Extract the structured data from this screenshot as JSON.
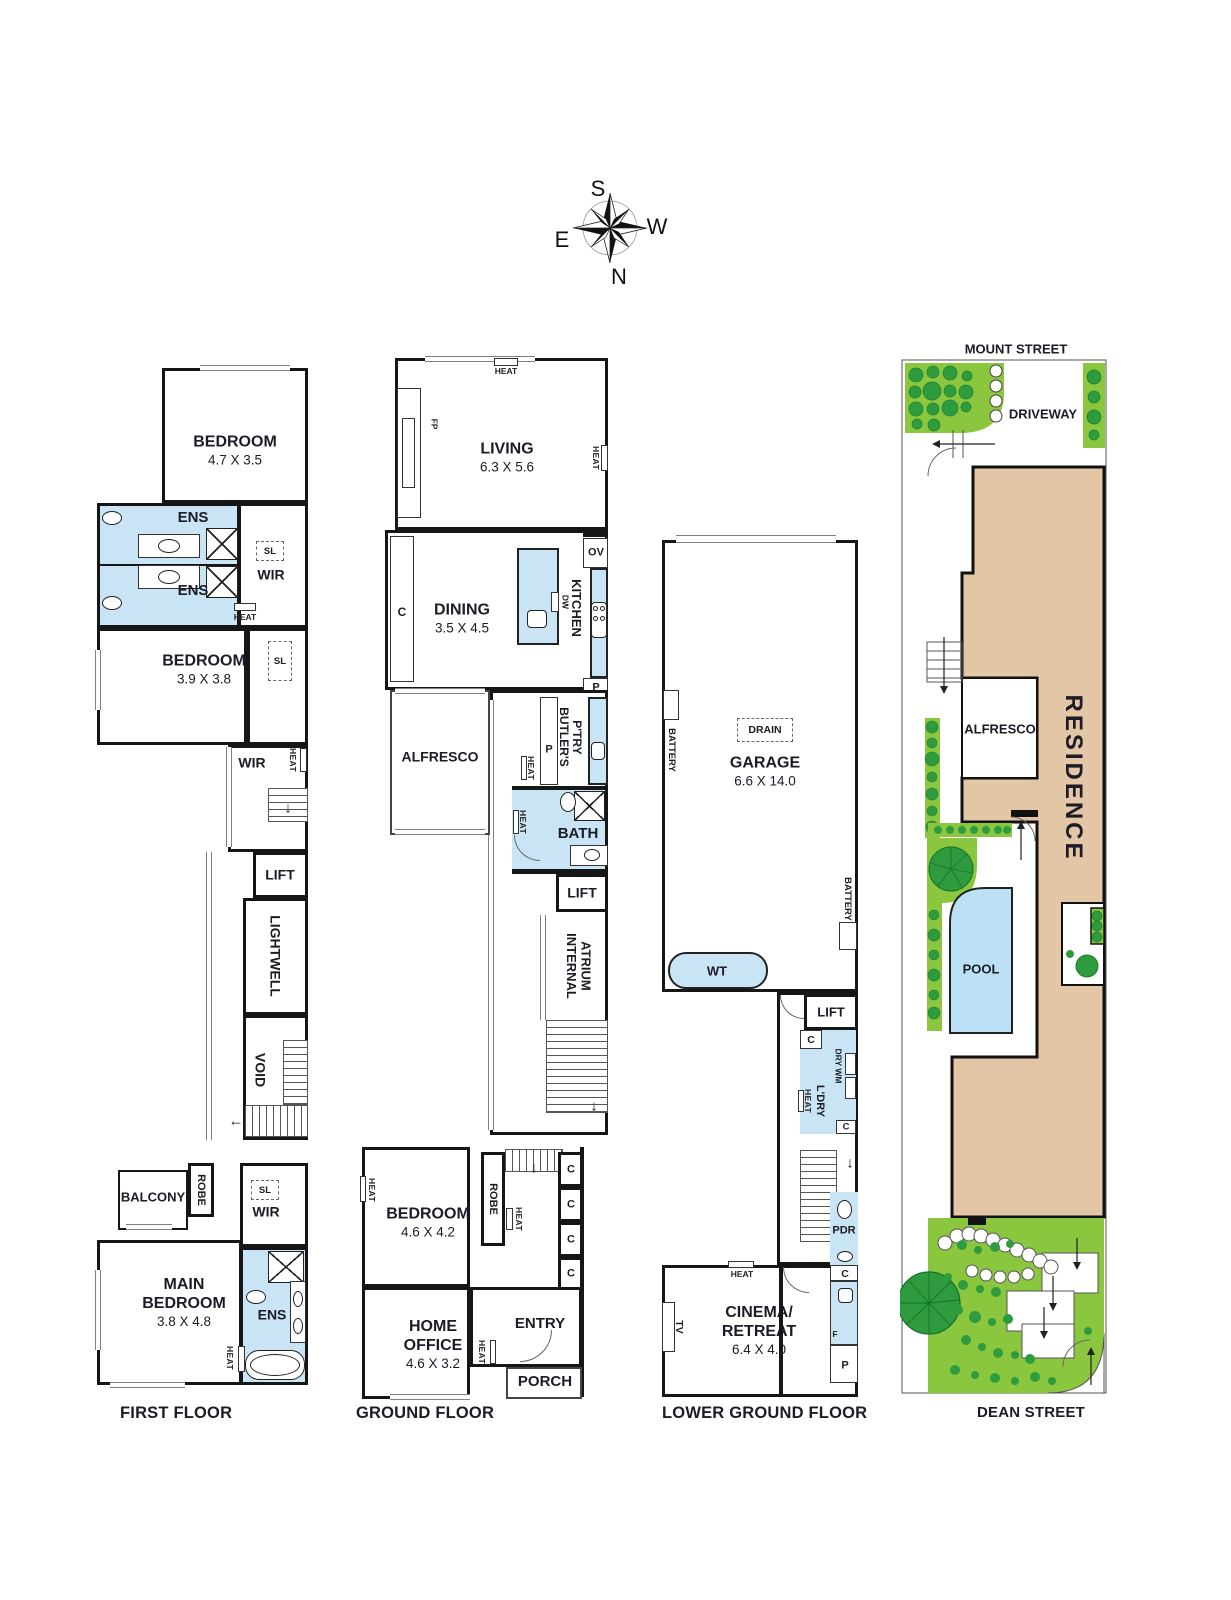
{
  "compass": {
    "top": "S",
    "right": "W",
    "left": "E",
    "bottom": "N"
  },
  "icons": {
    "down_arrow": "↓",
    "up_arrow": "↑",
    "left_arrow": "←"
  },
  "first_floor": {
    "caption": "FIRST FLOOR",
    "bedroom1": {
      "name": "BEDROOM",
      "dim": "4.7 X 3.5"
    },
    "ens_top": "ENS",
    "ens_mid": "ENS",
    "ens_main": "ENS",
    "sl_top": "SL",
    "sl_mid": "SL",
    "sl_lower": "SL",
    "wir_top": "WIR",
    "wir_mid": "WIR",
    "wir_lower": "WIR",
    "heat_ens": "HEAT",
    "heat_hall": "HEAT",
    "heat_main": "HEAT",
    "bedroom2": {
      "name": "BEDROOM",
      "dim": "3.9 X 3.8"
    },
    "lift": "LIFT",
    "lightwell": "LIGHTWELL",
    "void": "VOID",
    "balcony": "BALCONY",
    "robe": "ROBE",
    "main_bedroom": {
      "line1": "MAIN",
      "line2": "BEDROOM",
      "dim": "3.8 X 4.8"
    }
  },
  "ground_floor": {
    "caption": "GROUND FLOOR",
    "heat_living_top": "HEAT",
    "heat_living_right": "HEAT",
    "fp": "FP",
    "living": {
      "name": "LIVING",
      "dim": "6.3 X 5.6"
    },
    "cupboard": "C",
    "dining": {
      "name": "DINING",
      "dim": "3.5 X 4.5"
    },
    "dw": "DW",
    "kitchen": "KITCHEN",
    "oven": "OV",
    "pantry_kitchen": "P",
    "butlers": {
      "line1": "BUTLER'S",
      "line2": "P'TRY"
    },
    "pantry_butlers": "P",
    "heat_butlers": "HEAT",
    "alfresco": "ALFRESCO",
    "bath": "BATH",
    "heat_bath": "HEAT",
    "lift": "LIFT",
    "atrium": {
      "line1": "INTERNAL",
      "line2": "ATRIUM"
    },
    "heat_bedroom": "HEAT",
    "bedroom": {
      "name": "BEDROOM",
      "dim": "4.6 X 4.2"
    },
    "robe": "ROBE",
    "heat_robe": "HEAT",
    "c1": "C",
    "c2": "C",
    "c3": "C",
    "c4": "C",
    "home_office": {
      "line1": "HOME",
      "line2": "OFFICE",
      "dim": "4.6 X 3.2"
    },
    "entry": "ENTRY",
    "heat_entry": "HEAT",
    "porch": "PORCH"
  },
  "lower_ground": {
    "caption": "LOWER GROUND FLOOR",
    "battery_left": "BATTERY",
    "battery_right": "BATTERY",
    "drain": "DRAIN",
    "garage": {
      "name": "GARAGE",
      "dim": "6.6 X 14.0"
    },
    "water_tank": "WT",
    "lift": "LIFT",
    "c_top": "C",
    "dry_wm": "DRY WM",
    "laundry": "L'DRY",
    "heat_laundry": "HEAT",
    "c_mid": "C",
    "powder": "PDR",
    "c_right": "C",
    "heat_cinema": "HEAT",
    "tv": "TV",
    "cinema": {
      "line1": "CINEMA/",
      "line2": "RETREAT",
      "dim": "6.4 X 4.0"
    },
    "fridge": "F",
    "pantry": "P"
  },
  "site_plan": {
    "street_top": "MOUNT STREET",
    "driveway": "DRIVEWAY",
    "residence": "RESIDENCE",
    "alfresco": "ALFRESCO",
    "pool": "POOL",
    "street_bottom": "DEAN STREET"
  },
  "colors": {
    "wet_area": "#c9e4f4",
    "pool": "#bce0f6",
    "residence": "#e2c6a6",
    "grass": "#8bc63f",
    "shrub": "#2e9c3e",
    "wall": "#161616"
  }
}
